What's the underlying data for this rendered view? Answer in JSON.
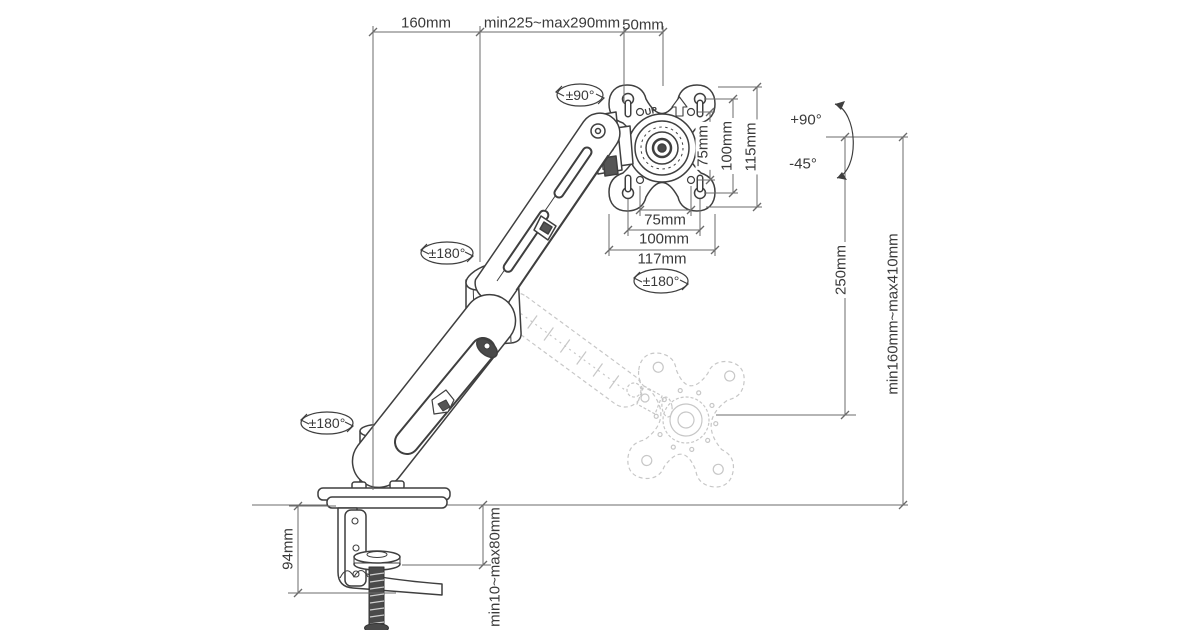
{
  "colors": {
    "ink": "#3f3f3f",
    "dim_line": "#6b6b6b",
    "ghost": "#c7c7c7",
    "screw_fill": "#4a4a4a",
    "background": "#ffffff"
  },
  "labels": {
    "top": {
      "offset": "160mm",
      "reach": "min225~max290mm",
      "head": "50mm"
    },
    "vesa": {
      "v75": "75mm",
      "v100": "100mm",
      "v115": "115mm",
      "h75": "75mm",
      "h100": "100mm",
      "h117": "117mm",
      "up": "UP"
    },
    "height": {
      "range": "250mm",
      "minmax": "min160mm~max410mm"
    },
    "clamp": {
      "height": "94mm",
      "desk": "min10~max80mm"
    },
    "rotation": {
      "head_swivel": "±90°",
      "elbow_swivel": "±180°",
      "base_swivel": "±180°",
      "vesa_rotation": "±180°",
      "tilt_up": "+90°",
      "tilt_down": "-45°"
    }
  }
}
